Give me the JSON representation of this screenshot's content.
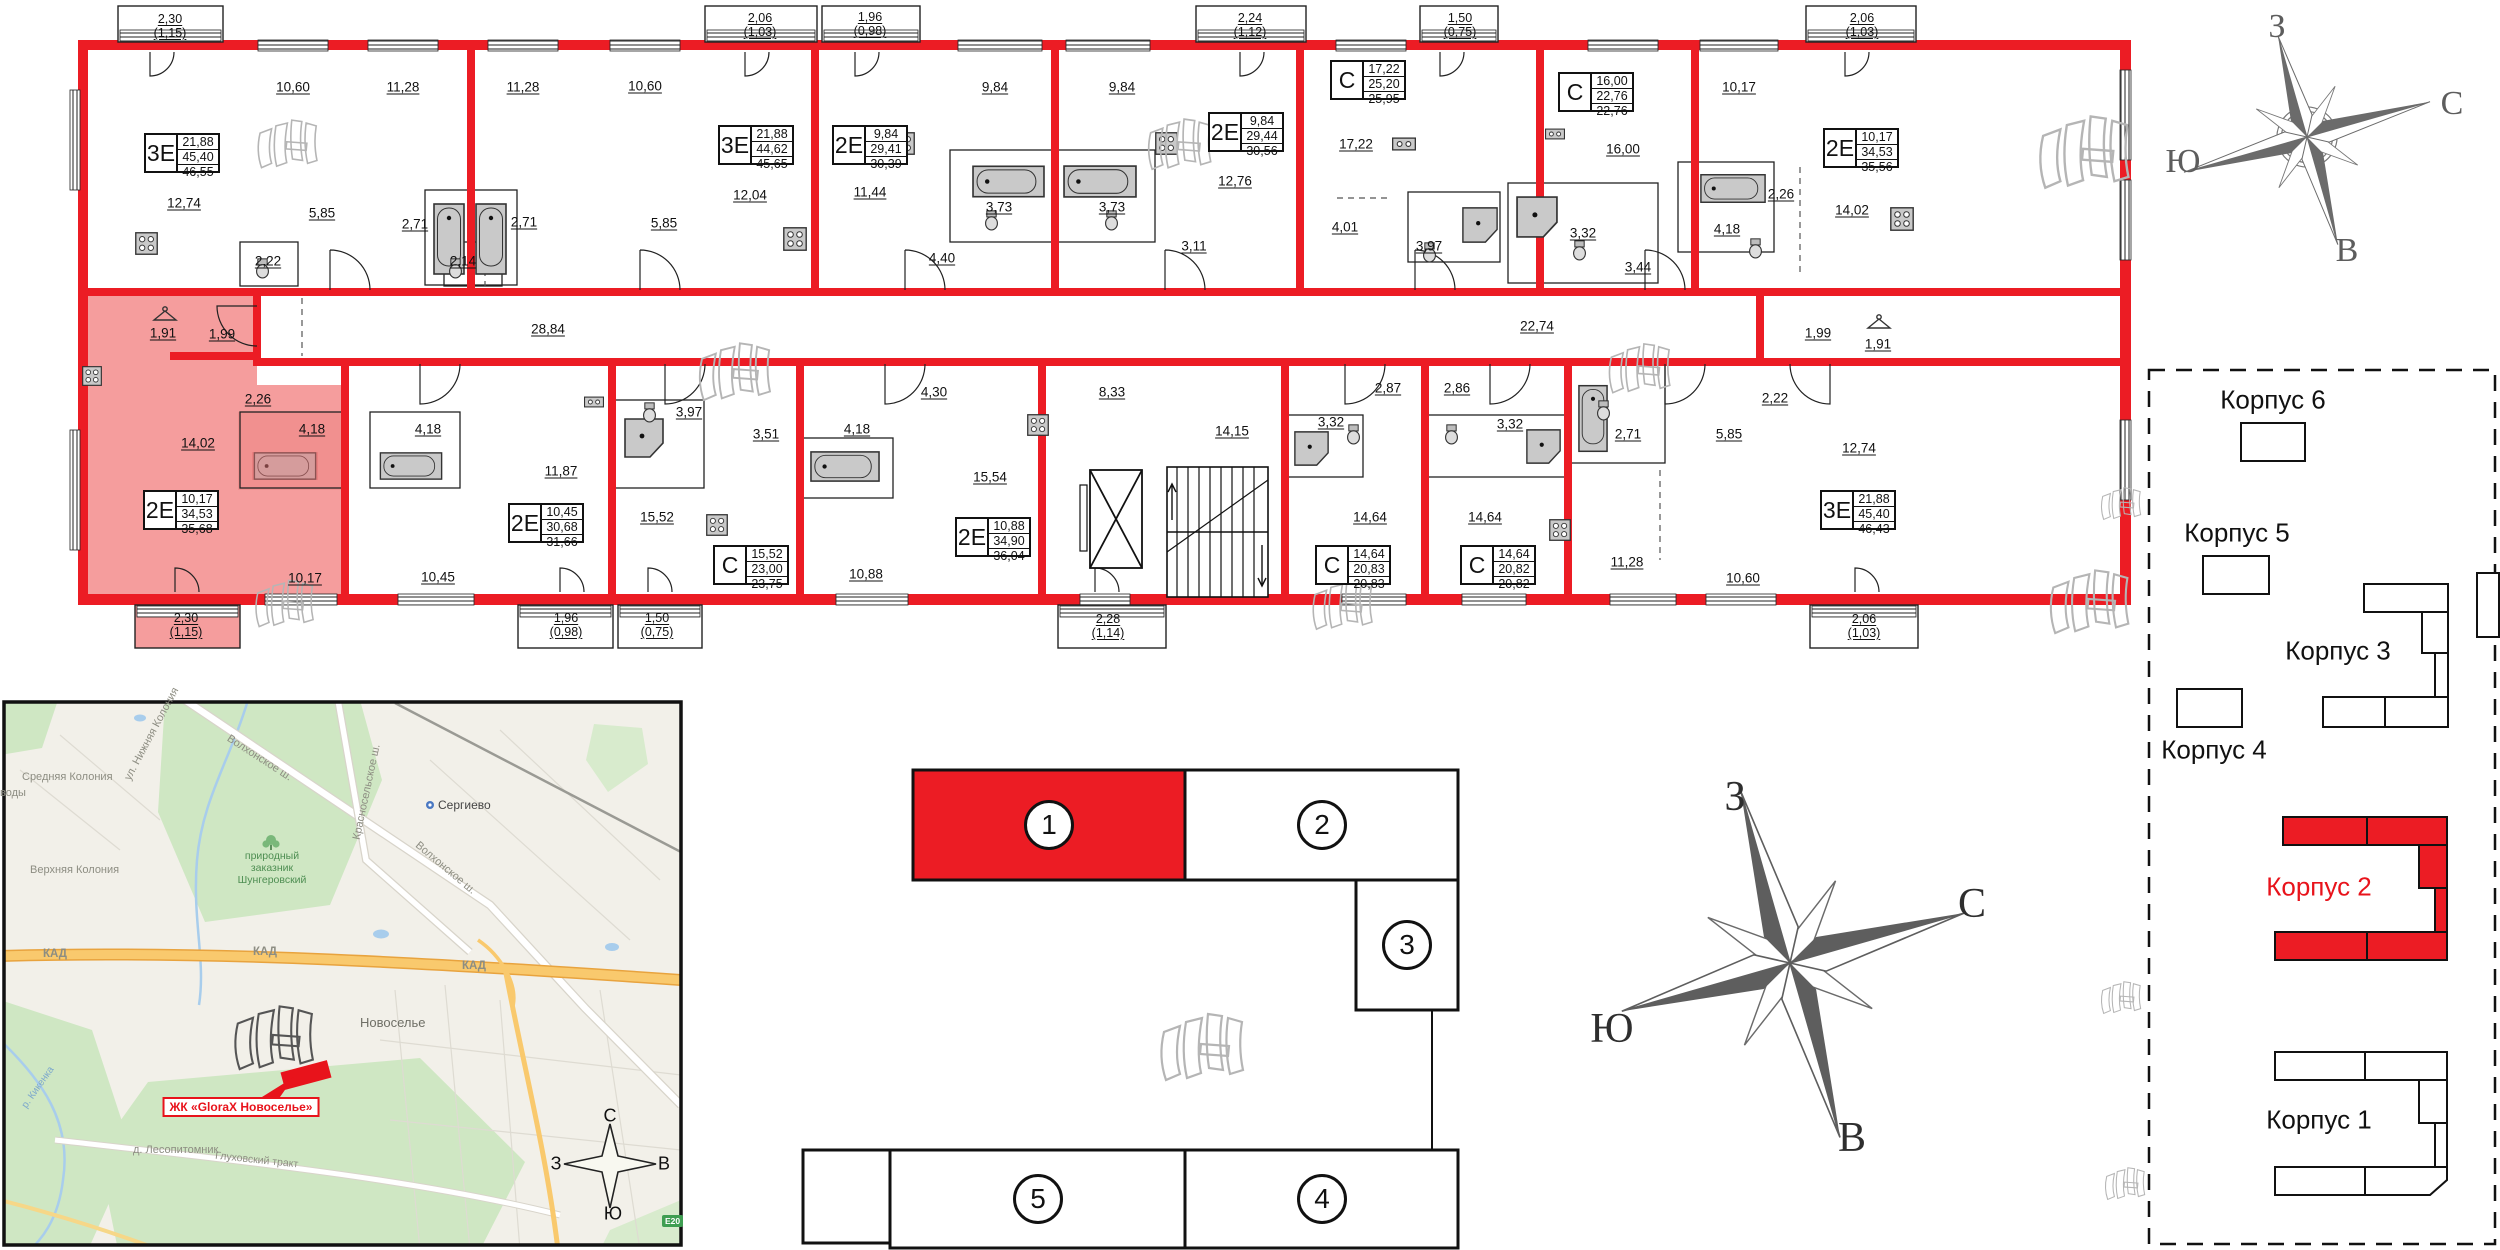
{
  "apartments": [
    {
      "type": "3Е",
      "v1": "21,88",
      "v2": "45,40",
      "v3": "46,55"
    },
    {
      "type": "3Е",
      "v1": "21,88",
      "v2": "44,62",
      "v3": "45,65"
    },
    {
      "type": "2Е",
      "v1": "9,84",
      "v2": "29,41",
      "v3": "30,39"
    },
    {
      "type": "2Е",
      "v1": "9,84",
      "v2": "29,44",
      "v3": "30,56"
    },
    {
      "type": "С",
      "v1": "17,22",
      "v2": "25,20",
      "v3": "25,95"
    },
    {
      "type": "С",
      "v1": "16,00",
      "v2": "22,76",
      "v3": "22,76"
    },
    {
      "type": "2Е",
      "v1": "10,17",
      "v2": "34,53",
      "v3": "35,56"
    },
    {
      "type": "2Е",
      "v1": "10,17",
      "v2": "34,53",
      "v3": "35,68"
    },
    {
      "type": "2Е",
      "v1": "10,45",
      "v2": "30,68",
      "v3": "31,66"
    },
    {
      "type": "С",
      "v1": "15,52",
      "v2": "23,00",
      "v3": "23,75"
    },
    {
      "type": "2Е",
      "v1": "10,88",
      "v2": "34,90",
      "v3": "36,04"
    },
    {
      "type": "С",
      "v1": "14,64",
      "v2": "20,83",
      "v3": "20,83"
    },
    {
      "type": "С",
      "v1": "14,64",
      "v2": "20,82",
      "v3": "20,82"
    },
    {
      "type": "3Е",
      "v1": "21,88",
      "v2": "45,40",
      "v3": "46,43"
    }
  ],
  "rooms": [
    "10,60",
    "11,28",
    "12,74",
    "5,85",
    "2,22",
    "2,71",
    "11,28",
    "10,60",
    "12,04",
    "5,85",
    "2,14",
    "2,71",
    "9,84",
    "11,44",
    "4,40",
    "3,73",
    "9,84",
    "3,73",
    "12,76",
    "3,11",
    "17,22",
    "4,01",
    "3,97",
    "16,00",
    "3,32",
    "3,44",
    "10,17",
    "14,02",
    "2,26",
    "4,18",
    "1,99",
    "1,91",
    "28,84",
    "22,74",
    "1,91",
    "1,99",
    "2,26",
    "4,18",
    "14,02",
    "10,17",
    "4,18",
    "11,87",
    "10,45",
    "3,97",
    "3,51",
    "15,52",
    "8,33",
    "14,15",
    "15,54",
    "4,30",
    "4,18",
    "10,88",
    "2,87",
    "2,86",
    "3,32",
    "3,32",
    "14,64",
    "14,64",
    "2,71",
    "5,85",
    "2,22",
    "12,74",
    "11,28",
    "10,60"
  ],
  "balconies": [
    {
      "a": "2,30",
      "b": "(1,15)"
    },
    {
      "a": "2,06",
      "b": "(1,03)"
    },
    {
      "a": "1,96",
      "b": "(0,98)"
    },
    {
      "a": "2,24",
      "b": "(1,12)"
    },
    {
      "a": "1,50",
      "b": "(0,75)"
    },
    {
      "a": "2,06",
      "b": "(1,03)"
    },
    {
      "a": "2,30",
      "b": "(1,15)"
    },
    {
      "a": "1,96",
      "b": "(0,98)"
    },
    {
      "a": "1,50",
      "b": "(0,75)"
    },
    {
      "a": "2,28",
      "b": "(1,14)"
    },
    {
      "a": "2,06",
      "b": "(1,03)"
    }
  ],
  "sections": [
    "1",
    "2",
    "3",
    "4",
    "5"
  ],
  "compass_small": {
    "top": "З",
    "right": "С",
    "left": "Ю",
    "bottom": "В"
  },
  "compass_big": {
    "top": "З",
    "right": "С",
    "left": "Ю",
    "bottom": "В"
  },
  "compass_map": {
    "top": "С",
    "left": "З",
    "right": "В",
    "bottom": "Ю"
  },
  "site": {
    "b6": "Корпус 6",
    "b5": "Корпус 5",
    "b3": "Корпус 3",
    "b4": "Корпус 4",
    "b2": "Корпус 2",
    "b1": "Корпус 1"
  },
  "map": {
    "badge": "ЖК «GloraX Новоселье»",
    "road_badge": "E20",
    "labels": {
      "srednyaya": "Средняя Колония",
      "vody": "воды",
      "nizhnyaya": "ул. Нижняя Колония",
      "verhnyaya": "Верхняя Колония",
      "volhonskoe1": "Волхонское ш.",
      "volhonskoe2": "Волхонское ш.",
      "krasnoselskoe": "Красносельское ш.",
      "sergievo": "Сергиево",
      "park1": "природный",
      "park2": "заказник",
      "park3": "Шунгеровский",
      "kad1": "КАД",
      "kad2": "КАД",
      "kad3": "КАД",
      "novoselye": "Новоселье",
      "lesopitomnik": "д. Лесопитомник",
      "gluhovskiy": "Глуховский тракт",
      "kikenka": "р. Кикенка"
    }
  },
  "colors": {
    "wall_red": "#ec1c24",
    "highlight_pink": "#f59d9d",
    "compass_gray": "#6b6b6b",
    "map_green": "#cfe7c3",
    "map_road_orange": "#f9c96d"
  }
}
